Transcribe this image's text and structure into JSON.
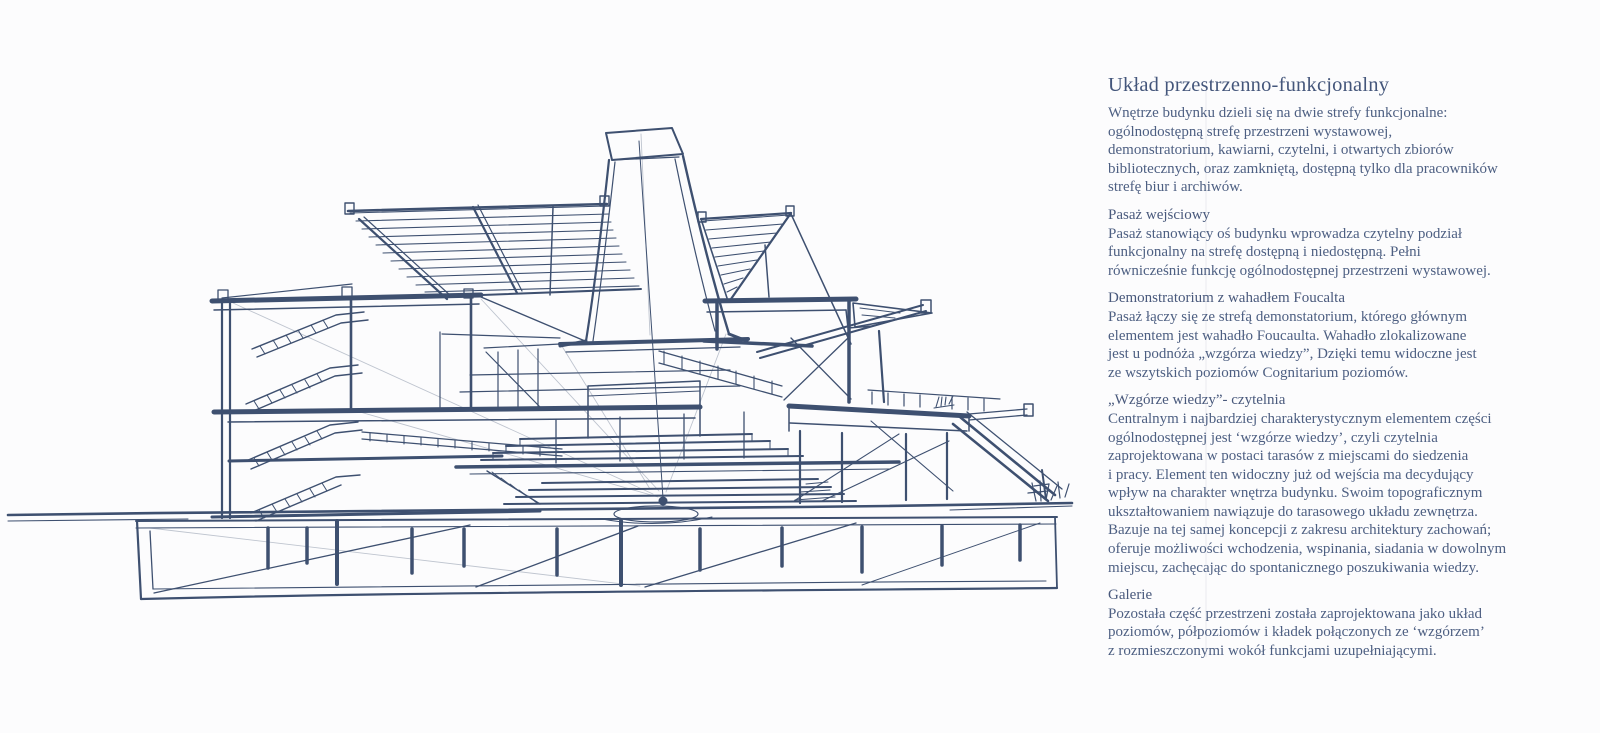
{
  "colors": {
    "background": "#fcfcfd",
    "sketch_ink": "#3e5070",
    "heading_text": "#44567b",
    "body_text": "#4d5f82"
  },
  "article": {
    "title": "Układ przestrzenno-funkcjonalny",
    "intro": "Wnętrze budynku dzieli się na dwie strefy funkcjonalne:\nogólnodostępną strefę przestrzeni wystawowej,\ndemonstratorium, kawiarni, czytelni, i otwartych zbiorów\nbibliotecznych, oraz zamkniętą, dostępną tylko dla pracowników\nstrefę biur i archiwów.",
    "sections": [
      {
        "title": "Pasaż wejściowy",
        "body": "Pasaż stanowiący oś budynku wprowadza czytelny podział\nfunkcjonalny na strefę dostępną i niedostępną. Pełni\nrównicześnie funkcję ogólnodostępnej przestrzeni wystawowej."
      },
      {
        "title": "Demonstratorium z wahadłem Foucalta",
        "body": "Pasaż łączy się ze strefą demonstatorium, którego głównym\nelementem jest wahadło Foucaulta. Wahadło zlokalizowane\njest u podnóża „wzgórza wiedzy”, Dzięki temu widoczne jest\nze wszytskich poziomów Cognitarium poziomów."
      },
      {
        "title": "„Wzgórze wiedzy”- czytelnia",
        "body": "Centralnym i najbardziej charakterystycznym elementem części\nogólnodostępnej jest ‘wzgórze wiedzy’, czyli czytelnia\nzaprojektowana w postaci tarasów z miejscami do siedzenia\ni pracy. Element ten widoczny już od wejścia ma decydujący\nwpływ na charakter wnętrza budynku. Swoim topograficznym\nukształtowaniem nawiązuje do tarasowego układu zewnętrza.\nBazuje na tej samej koncepcji z zakresu architektury zachowań;\noferuje możliwości wchodzenia, wspinania, siadania w dowolnym\nmiejscu, zachęcając do spontanicznego poszukiwania wiedzy."
      },
      {
        "title": "Galerie",
        "body": "Pozostała część przestrzeni została zaprojektowana jako układ\npoziomów, półpoziomów i kładek połączonych ze ‘wzgórzem’\nz rozmieszczonymi wokół funkcjami uzupełniającymi."
      }
    ]
  }
}
